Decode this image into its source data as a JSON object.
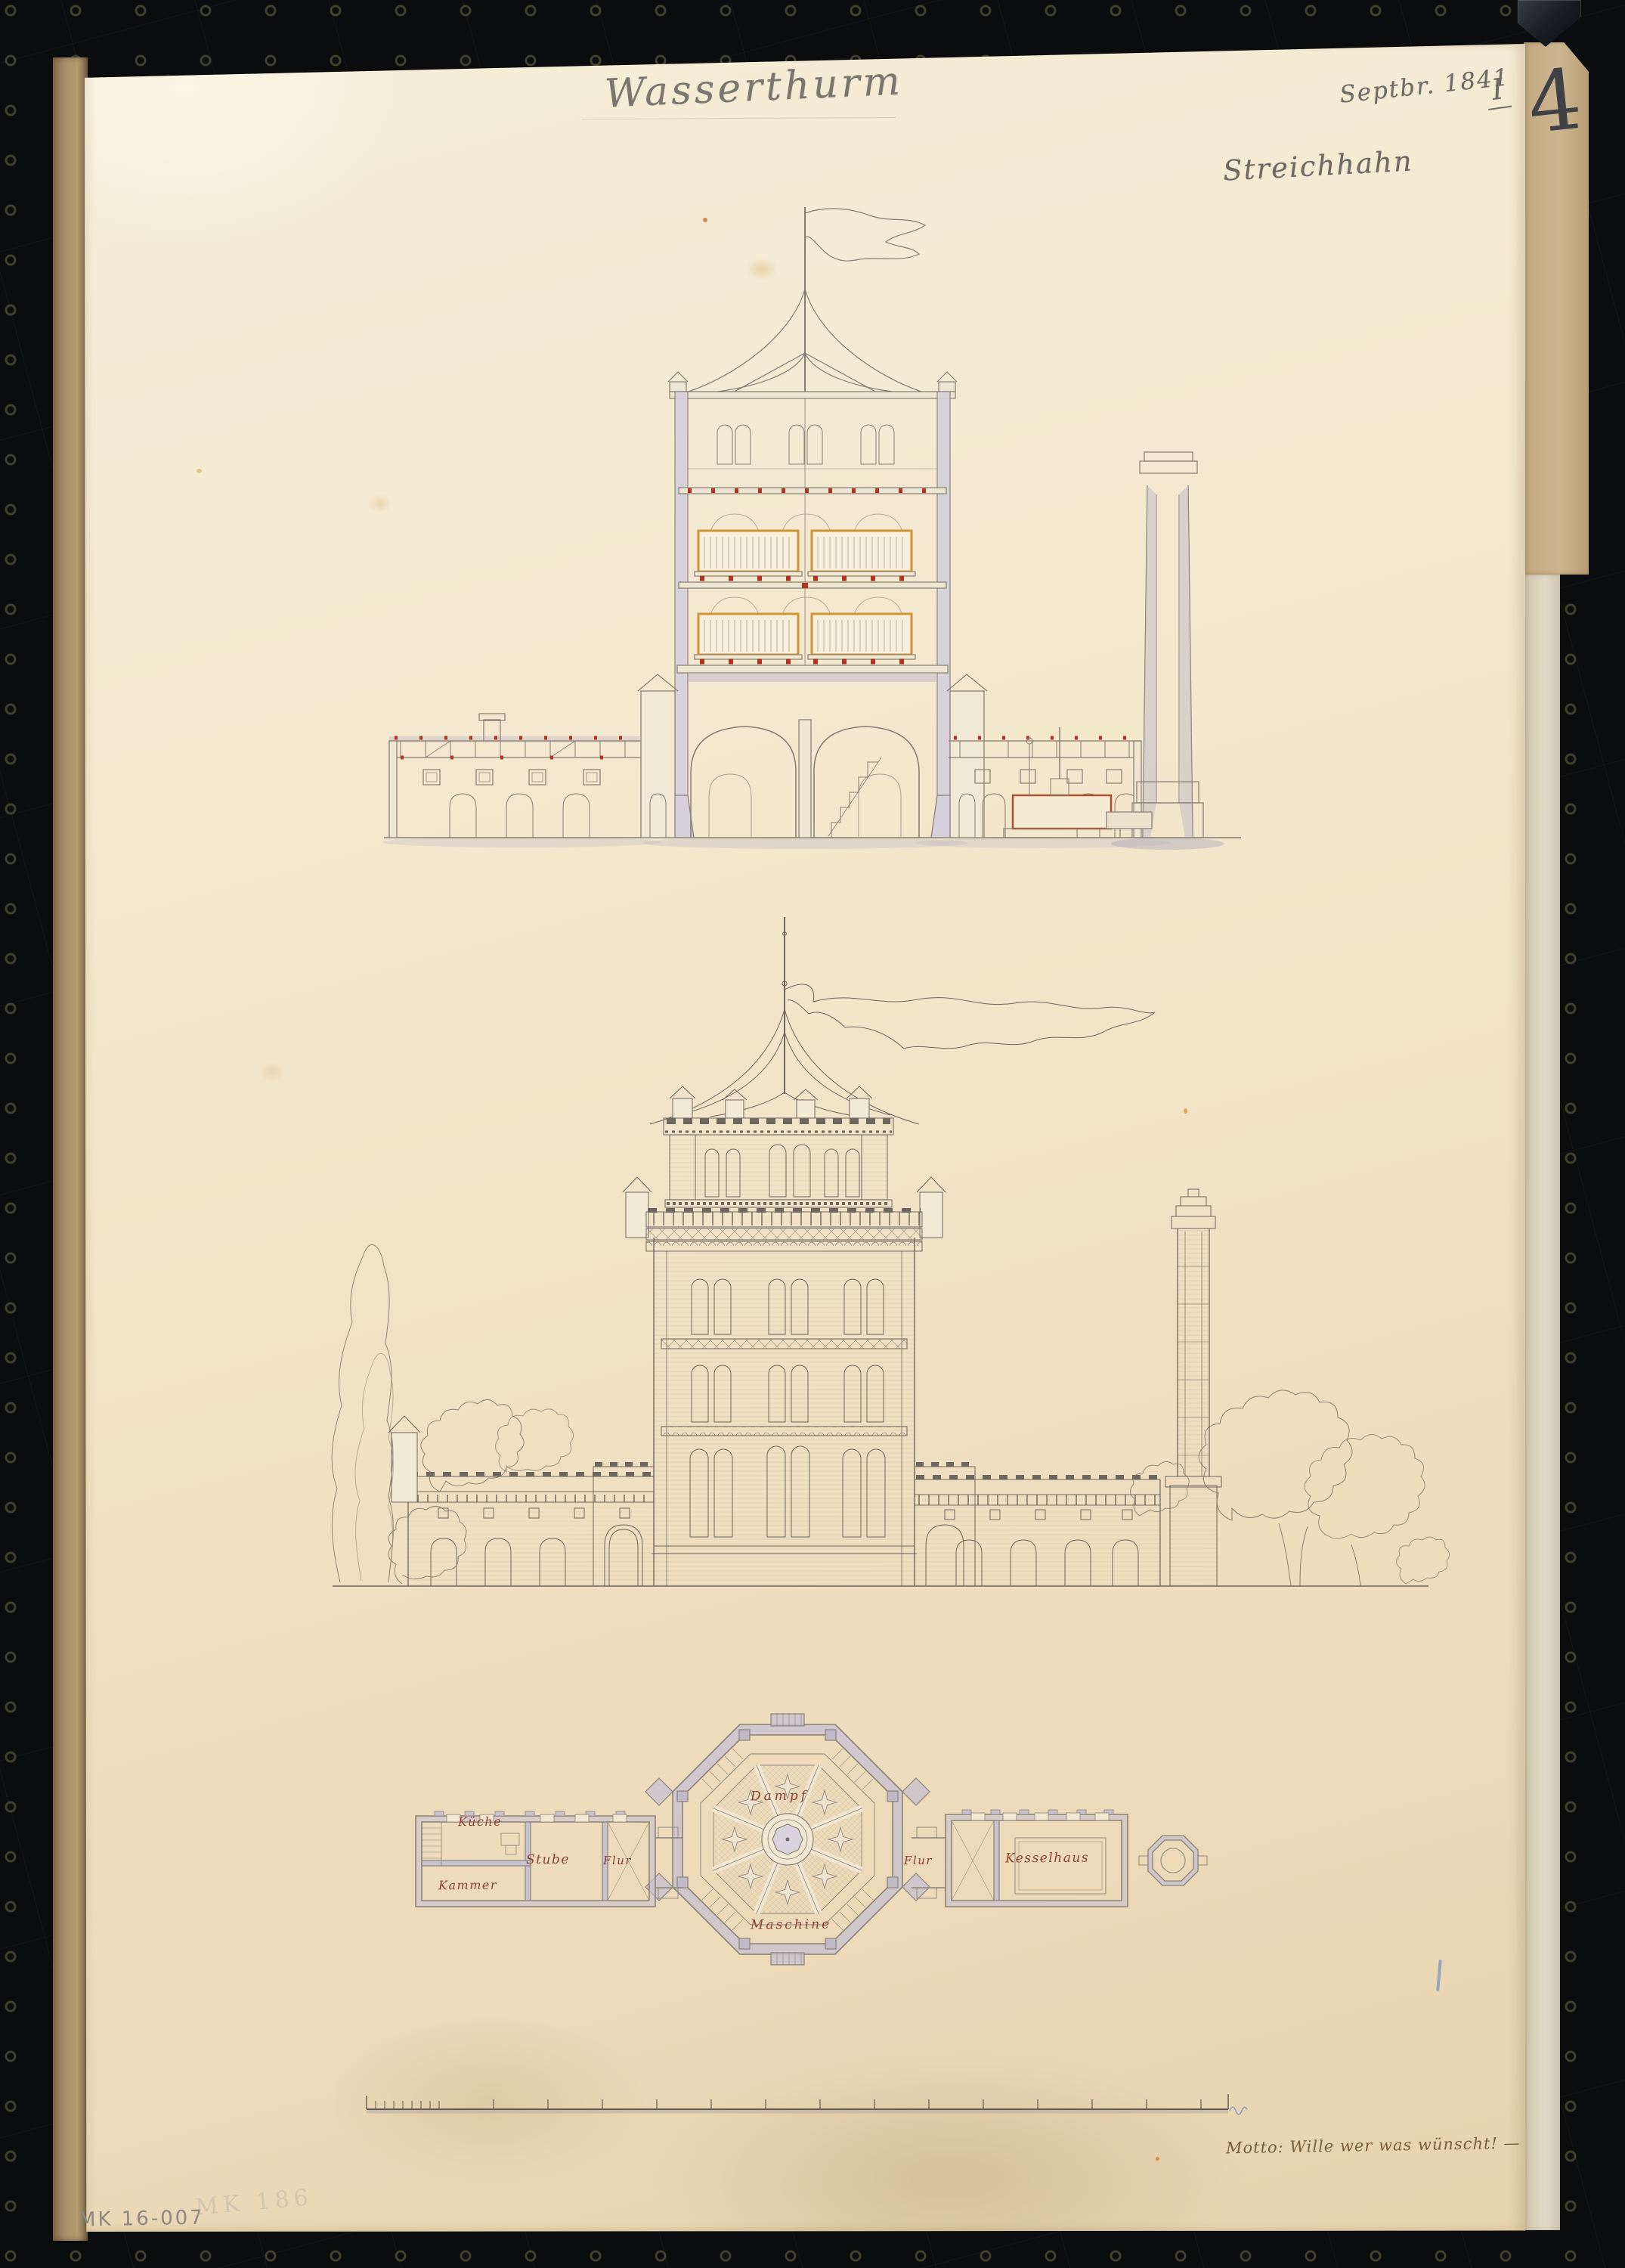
{
  "sheet": {
    "title": "Wasserthurm",
    "date_annotation": "Septbr. 1841",
    "series_numeral": "I",
    "corner_number": "4",
    "name_inscription": "Streichhahn",
    "motto": "Motto: Wille wer was wünscht! —",
    "inventory_number": "MK 16-007",
    "inventory_number_ghost": "MK 186"
  },
  "plan": {
    "labels": {
      "dampf": "Dampf",
      "maschine": "Maschine",
      "kueche": "Küche",
      "kammer": "Kammer",
      "stube": "Stube",
      "flur_left": "Flur",
      "flur_right": "Flur",
      "kesselhaus": "Kesselhaus"
    }
  },
  "scale_bar": {
    "minor_ticks": 8,
    "major_ticks": 15
  },
  "colors": {
    "scanner_black": "#0a0c0e",
    "backing_board": "#a8906a",
    "paper": "#f3e7cc",
    "ink_line": "#6e675e",
    "pencil": "#77726c",
    "violet_wash": "#beb6c6",
    "tank_orange": "#cf9434",
    "accent_red": "#b23222",
    "room_label_red": "#8f4034",
    "motto_ink": "#7b5e3b",
    "blue_pencil": "#5f86c0"
  }
}
